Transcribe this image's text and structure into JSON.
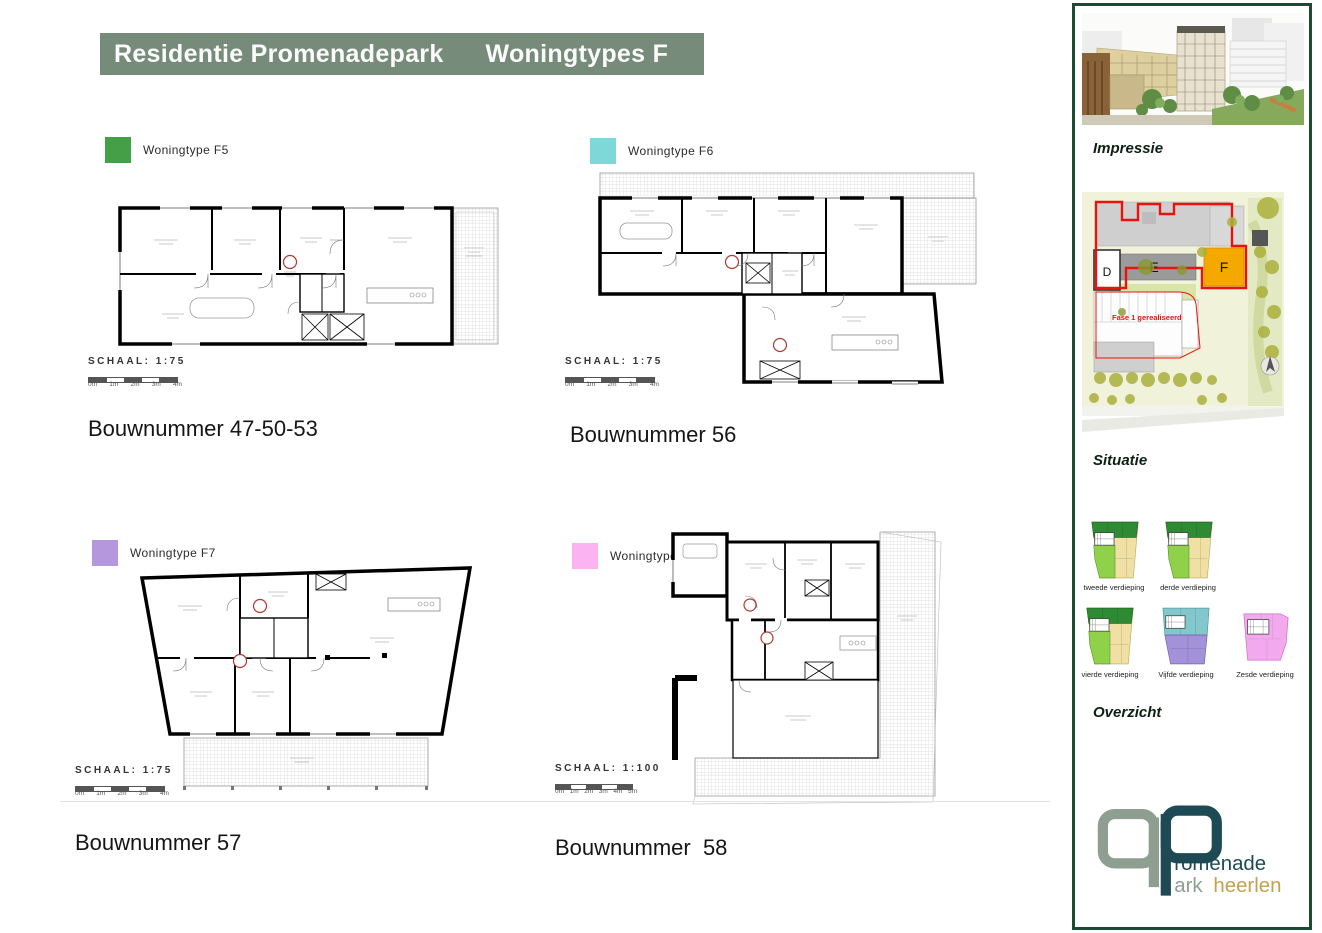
{
  "title": {
    "left": "Residentie Promenadepark",
    "right": "Woningtypes F"
  },
  "colors": {
    "title_bg": "#778b7b",
    "f5_green": "#43a047",
    "f6_teal": "#7fd8d8",
    "f7_purple": "#b497dd",
    "f8_pink": "#fbb3f2",
    "sidebar_border": "#1c4b33",
    "situatie_building_f": "#f5a800",
    "logo_gray": "#8e9e90",
    "logo_teal": "#1d4a54",
    "logo_gold": "#c2a24e"
  },
  "plans": [
    {
      "legend": "Woningtype F5",
      "legend_color": "#43a047",
      "schaal": "SCHAAL: 1:75",
      "scale_ticks": [
        "0m",
        "1m",
        "2m",
        "3m",
        "4m"
      ],
      "bouwnummer": "Bouwnummer 47-50-53"
    },
    {
      "legend": "Woningtype F6",
      "legend_color": "#7fd8d8",
      "schaal": "SCHAAL: 1:75",
      "scale_ticks": [
        "0m",
        "1m",
        "2m",
        "3m",
        "4m"
      ],
      "bouwnummer": "Bouwnummer 56"
    },
    {
      "legend": "Woningtype F7",
      "legend_color": "#b497dd",
      "schaal": "SCHAAL: 1:75",
      "scale_ticks": [
        "0m",
        "1m",
        "2m",
        "3m",
        "4m"
      ],
      "bouwnummer": "Bouwnummer 57"
    },
    {
      "legend": "Woningtype F8",
      "legend_color": "#fbb3f2",
      "schaal": "SCHAAL: 1:100",
      "scale_ticks": [
        "0m",
        "1m",
        "2m",
        "3m",
        "4m",
        "5m"
      ],
      "bouwnummer": "Bouwnummer  58"
    }
  ],
  "sidebar": {
    "impressie_label": "Impressie",
    "situatie_label": "Situatie",
    "overzicht_label": "Overzicht",
    "situatie": {
      "building_d": "D",
      "building_e": "E",
      "building_f": "F",
      "fase_text": "Fase 1 gerealiseerd"
    },
    "floors": [
      {
        "label": "tweede verdieping"
      },
      {
        "label": "derde verdieping"
      },
      {
        "label": "vierde verdieping"
      },
      {
        "label": "Vijfde verdieping"
      },
      {
        "label": "Zesde verdieping"
      }
    ],
    "logo": {
      "line1": "romenade",
      "line2": "ark",
      "line3": "heerlen"
    }
  }
}
